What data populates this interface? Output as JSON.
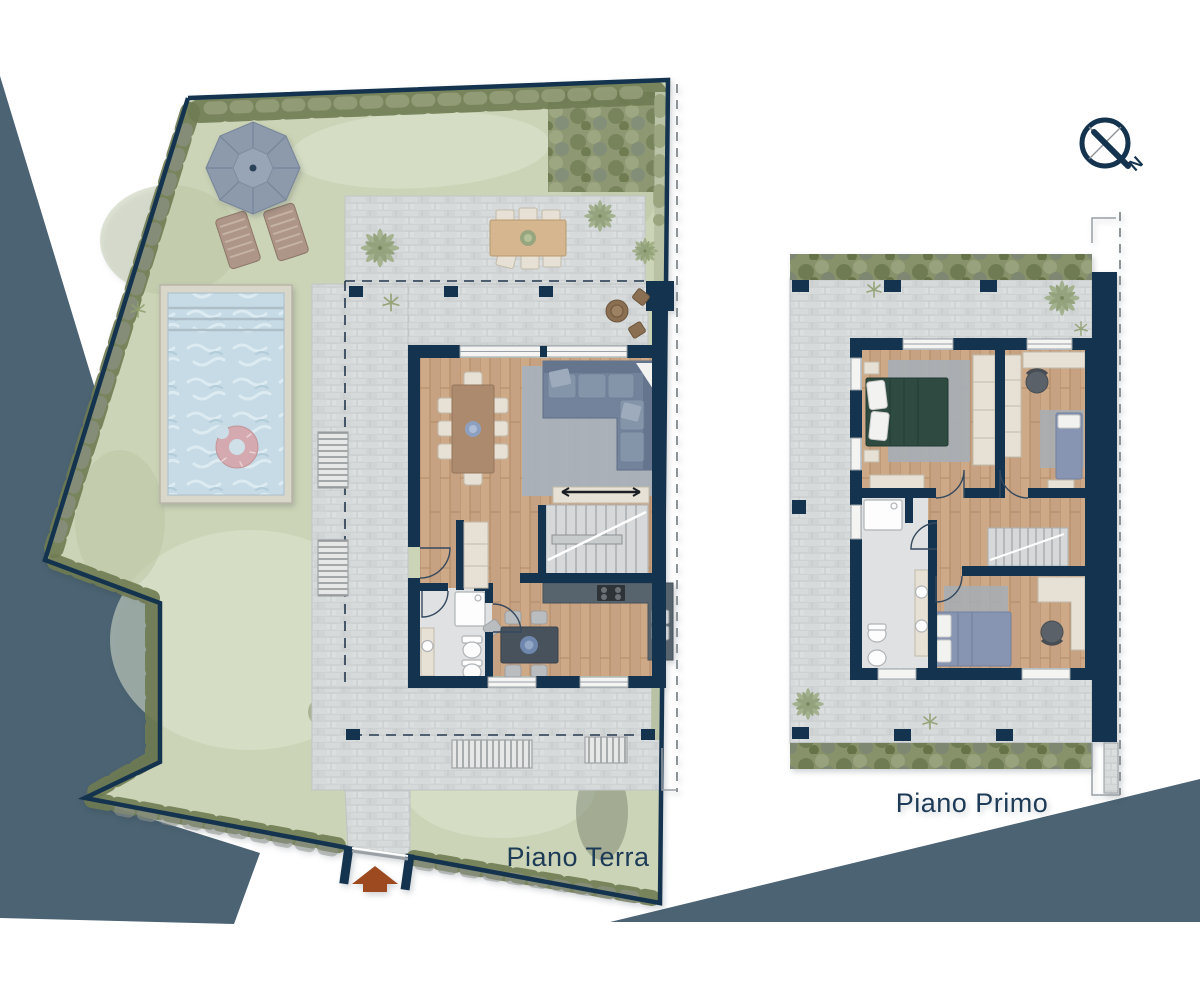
{
  "labels": {
    "ground_floor": "Piano Terra",
    "first_floor": "Piano Primo"
  },
  "compass": {
    "north_letter": "N"
  },
  "icons": {
    "compass": "compass-icon",
    "entrance_arrow": "entrance-arrow-icon",
    "umbrella": "umbrella-icon",
    "palm": "palm-icon"
  },
  "colors": {
    "background": "#ffffff",
    "slate_decor": "#4b6372",
    "navy": "#14334e",
    "label_text": "#1d3b57",
    "grass": "#ccd4b7",
    "hedge_dark": "#6f7b52",
    "paver": "#d7dadb",
    "wood": "#c6a182",
    "water": "#c6dbe5",
    "pool_frame": "#d9d6ca",
    "rug": "#a9b1ba",
    "sofa": "#72839b",
    "bed_green": "#2e4a41",
    "bed_blue": "#8795b2",
    "furniture_cream": "#e7e1d5",
    "counter_dark": "#57636d",
    "umbrella_gray": "#8d9aac",
    "lounger_brown": "#ad9587",
    "donut_pink": "#d4a9af",
    "entrance_arrow_rust": "#9d4a20",
    "dash_gray": "#8e9599"
  }
}
